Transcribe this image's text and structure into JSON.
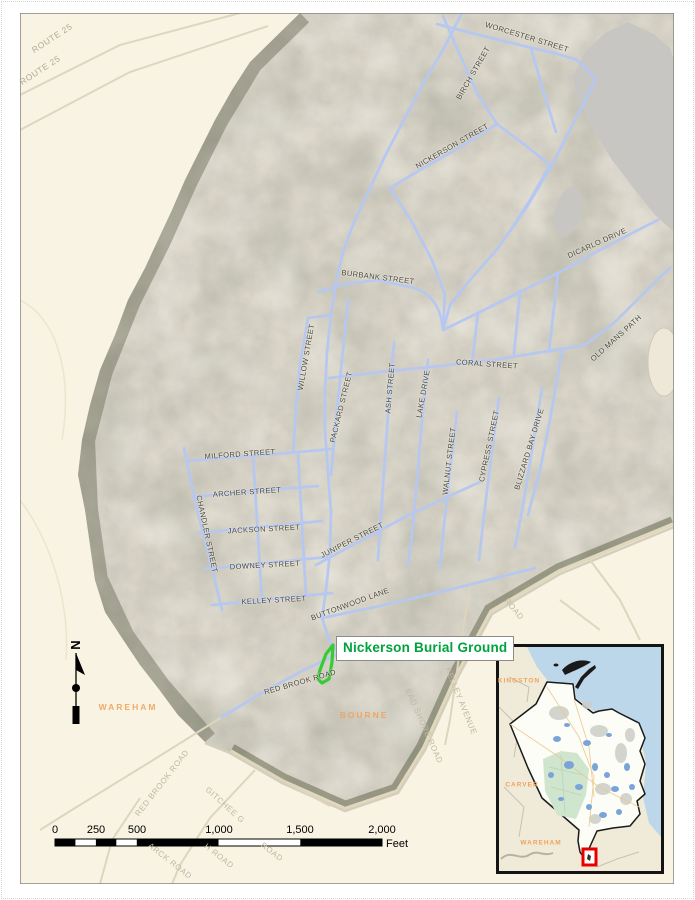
{
  "poi": {
    "label": "Nickerson Burial Ground",
    "color": "#00a33c",
    "outline_color": "#35cb35"
  },
  "north": {
    "letter": "N"
  },
  "scalebar": {
    "ticks": [
      {
        "t": "0",
        "x": 55
      },
      {
        "t": "250",
        "x": 96
      },
      {
        "t": "500",
        "x": 137
      },
      {
        "t": "1,000",
        "x": 219
      },
      {
        "t": "1,500",
        "x": 300
      },
      {
        "t": "2,000",
        "x": 382
      }
    ],
    "unit": "Feet"
  },
  "colors": {
    "map_background": "#f8f3e2",
    "aerial_base": "#ddd8cb",
    "street_line": "#b7c8f0",
    "water": "#c7c6c2",
    "inset_water": "#bcd7ea",
    "town_label": "#f0a35f",
    "extent_box": "#e80000"
  },
  "labels": [
    {
      "t": "ROUTE 25",
      "x": 52,
      "y": 38,
      "r": -33,
      "c": "route"
    },
    {
      "t": "ROUTE 25",
      "x": 40,
      "y": 70,
      "r": -33,
      "c": "route"
    },
    {
      "t": "WORCESTER STREET",
      "x": 527,
      "y": 37,
      "r": 17,
      "c": "street"
    },
    {
      "t": "BIRCH STREET",
      "x": 473,
      "y": 73,
      "r": -60,
      "c": "street"
    },
    {
      "t": "NICKERSON STREET",
      "x": 452,
      "y": 146,
      "r": -30,
      "c": "street"
    },
    {
      "t": "BURBANK STREET",
      "x": 378,
      "y": 277,
      "r": 7,
      "c": "street"
    },
    {
      "t": "DICARLO DRIVE",
      "x": 597,
      "y": 243,
      "r": -24,
      "c": "street"
    },
    {
      "t": "OLD MANS PATH",
      "x": 616,
      "y": 338,
      "r": -42,
      "c": "street"
    },
    {
      "t": "CORAL STREET",
      "x": 487,
      "y": 364,
      "r": 4,
      "c": "street"
    },
    {
      "t": "WILLOW STREET",
      "x": 306,
      "y": 357,
      "r": -80,
      "c": "street"
    },
    {
      "t": "PACKARD STREET",
      "x": 341,
      "y": 407,
      "r": -76,
      "c": "street"
    },
    {
      "t": "ASH STREET",
      "x": 390,
      "y": 388,
      "r": -85,
      "c": "street"
    },
    {
      "t": "LAKE DRIVE",
      "x": 423,
      "y": 394,
      "r": -80,
      "c": "street"
    },
    {
      "t": "WALNUT STREET",
      "x": 449,
      "y": 461,
      "r": -83,
      "c": "street"
    },
    {
      "t": "CYPRESS STREET",
      "x": 489,
      "y": 446,
      "r": -78,
      "c": "street"
    },
    {
      "t": "BLIZZARD BAY DRIVE",
      "x": 529,
      "y": 449,
      "r": -73,
      "c": "street"
    },
    {
      "t": "MILFORD STREET",
      "x": 240,
      "y": 454,
      "r": -4,
      "c": "street"
    },
    {
      "t": "ARCHER STREET",
      "x": 247,
      "y": 492,
      "r": -4,
      "c": "street"
    },
    {
      "t": "CHANDLER STREET",
      "x": 207,
      "y": 534,
      "r": 78,
      "c": "street"
    },
    {
      "t": "JACKSON STREET",
      "x": 264,
      "y": 529,
      "r": -3,
      "c": "street"
    },
    {
      "t": "JUNIPER STREET",
      "x": 352,
      "y": 540,
      "r": -27,
      "c": "street"
    },
    {
      "t": "DOWNEY STREET",
      "x": 265,
      "y": 565,
      "r": -3,
      "c": "street"
    },
    {
      "t": "KELLEY STREET",
      "x": 274,
      "y": 600,
      "r": -3,
      "c": "street"
    },
    {
      "t": "BUTTONWOOD LANE",
      "x": 350,
      "y": 604,
      "r": -20,
      "c": "street"
    },
    {
      "t": "RED BROOK ROAD",
      "x": 300,
      "y": 682,
      "r": -16,
      "c": "street"
    },
    {
      "t": "KELLEY AVENUE",
      "x": 461,
      "y": 701,
      "r": 68,
      "c": "faint"
    },
    {
      "t": "EAD SHORE ROAD",
      "x": 424,
      "y": 726,
      "r": 66,
      "c": "faint"
    },
    {
      "t": "ROAD",
      "x": 514,
      "y": 609,
      "r": 50,
      "c": "faint"
    },
    {
      "t": "RED BROOK ROAD",
      "x": 162,
      "y": 783,
      "r": -52,
      "c": "faint"
    },
    {
      "t": "GITCHEE G",
      "x": 225,
      "y": 805,
      "r": 42,
      "c": "faint"
    },
    {
      "t": "H ROAD",
      "x": 219,
      "y": 856,
      "r": 38,
      "c": "faint"
    },
    {
      "t": "ARCK ROAD",
      "x": 170,
      "y": 861,
      "r": 38,
      "c": "faint"
    },
    {
      "t": "ROAD",
      "x": 272,
      "y": 852,
      "r": 38,
      "c": "faint"
    },
    {
      "t": "WAREHAM",
      "x": 128,
      "y": 707,
      "r": 0,
      "c": "town"
    },
    {
      "t": "BOURNE",
      "x": 364,
      "y": 715,
      "r": 0,
      "c": "town"
    },
    {
      "t": "KINGSTON",
      "x": 519,
      "y": 681,
      "r": 0,
      "c": "town-small"
    },
    {
      "t": "CARVER",
      "x": 522,
      "y": 785,
      "r": 0,
      "c": "town-small"
    },
    {
      "t": "WAREHAM",
      "x": 541,
      "y": 843,
      "r": 0,
      "c": "town-small"
    }
  ]
}
